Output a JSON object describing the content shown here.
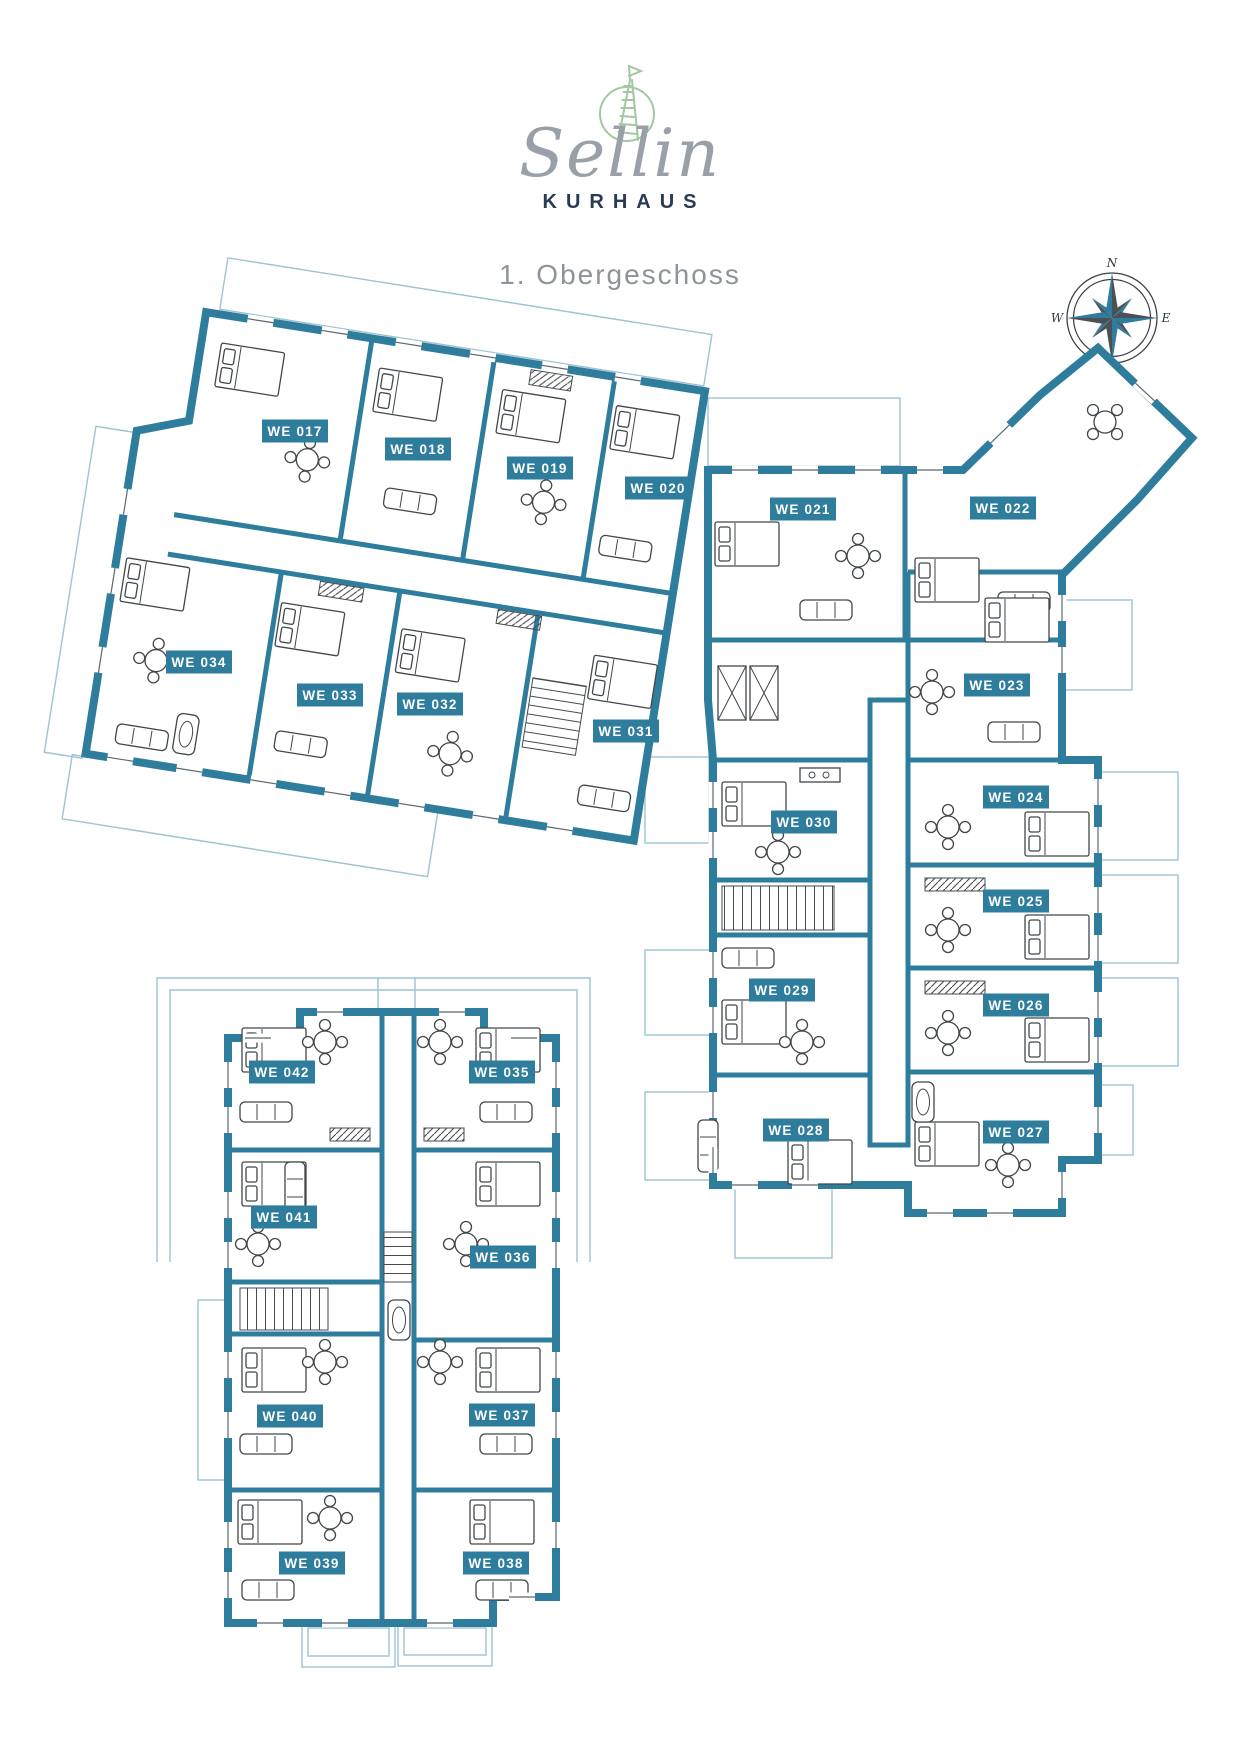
{
  "brand": {
    "name": "Sellin",
    "subtitle": "KURHAUS"
  },
  "floor": {
    "title": "1. Obergeschoss"
  },
  "compass": {
    "north": "N",
    "east": "E",
    "south": "S",
    "west": "W"
  },
  "colors": {
    "wall_teal": "#2e7d9c",
    "outline_blue": "#9dc3d4",
    "navy": "#2b3a55",
    "logo_green": "#a3c7a1",
    "script_gray": "#9aa0a8",
    "title_gray": "#8d949c",
    "label_text": "#ffffff"
  },
  "floor_plan": {
    "units": [
      {
        "id": "we-017",
        "label": "WE 017",
        "x": 295,
        "y": 431
      },
      {
        "id": "we-018",
        "label": "WE 018",
        "x": 418,
        "y": 449
      },
      {
        "id": "we-019",
        "label": "WE 019",
        "x": 540,
        "y": 468
      },
      {
        "id": "we-020",
        "label": "WE 020",
        "x": 658,
        "y": 488
      },
      {
        "id": "we-021",
        "label": "WE 021",
        "x": 803,
        "y": 509
      },
      {
        "id": "we-022",
        "label": "WE 022",
        "x": 1003,
        "y": 508
      },
      {
        "id": "we-023",
        "label": "WE 023",
        "x": 997,
        "y": 685
      },
      {
        "id": "we-024",
        "label": "WE 024",
        "x": 1016,
        "y": 797
      },
      {
        "id": "we-025",
        "label": "WE 025",
        "x": 1016,
        "y": 901
      },
      {
        "id": "we-026",
        "label": "WE 026",
        "x": 1016,
        "y": 1005
      },
      {
        "id": "we-027",
        "label": "WE 027",
        "x": 1016,
        "y": 1132
      },
      {
        "id": "we-028",
        "label": "WE 028",
        "x": 796,
        "y": 1130
      },
      {
        "id": "we-029",
        "label": "WE 029",
        "x": 782,
        "y": 990
      },
      {
        "id": "we-030",
        "label": "WE 030",
        "x": 804,
        "y": 822
      },
      {
        "id": "we-031",
        "label": "WE 031",
        "x": 626,
        "y": 731
      },
      {
        "id": "we-032",
        "label": "WE 032",
        "x": 430,
        "y": 704
      },
      {
        "id": "we-033",
        "label": "WE 033",
        "x": 330,
        "y": 695
      },
      {
        "id": "we-034",
        "label": "WE 034",
        "x": 199,
        "y": 662
      },
      {
        "id": "we-035",
        "label": "WE 035",
        "x": 502,
        "y": 1072
      },
      {
        "id": "we-036",
        "label": "WE 036",
        "x": 503,
        "y": 1257
      },
      {
        "id": "we-037",
        "label": "WE 037",
        "x": 502,
        "y": 1415
      },
      {
        "id": "we-038",
        "label": "WE 038",
        "x": 496,
        "y": 1563
      },
      {
        "id": "we-039",
        "label": "WE 039",
        "x": 312,
        "y": 1563
      },
      {
        "id": "we-040",
        "label": "WE 040",
        "x": 290,
        "y": 1416
      },
      {
        "id": "we-041",
        "label": "WE 041",
        "x": 284,
        "y": 1217
      },
      {
        "id": "we-042",
        "label": "WE 042",
        "x": 282,
        "y": 1072
      }
    ]
  }
}
